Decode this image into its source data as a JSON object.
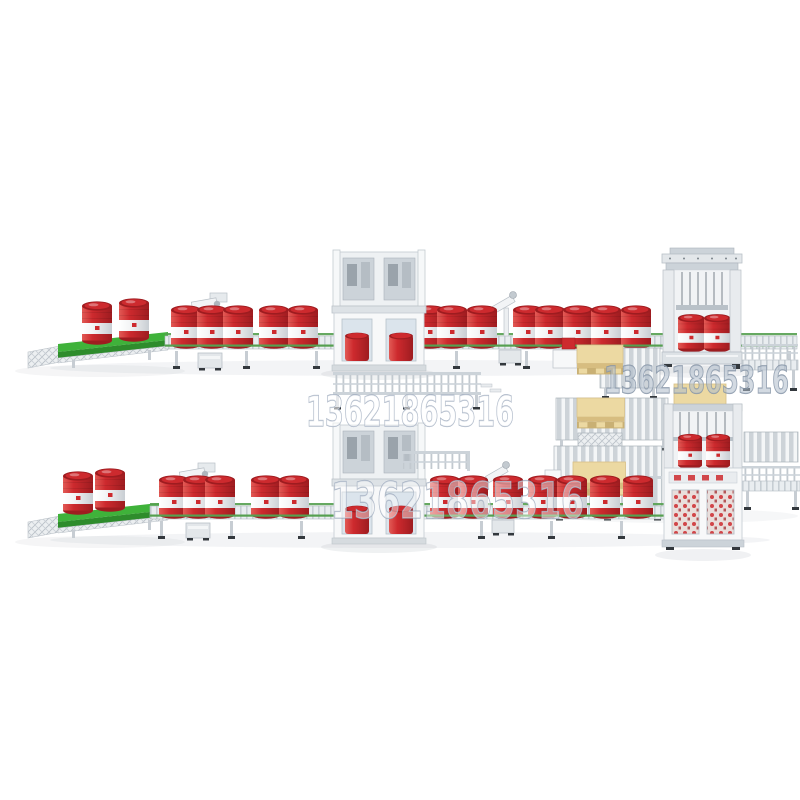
{
  "image": {
    "alt": "3D render of an automatic oil-drum filling and palletizing production line: two parallel conveyor lines with red drums, filling cabinets, capping robots, and a palletizing area with wooden pallets on the right"
  },
  "watermarks": [
    {
      "text": "13621865316",
      "position": "top-right"
    },
    {
      "text": "13621865316",
      "position": "center"
    },
    {
      "text": "13621865316",
      "position": "bottom-center"
    }
  ],
  "colors": {
    "background": "#ffffff",
    "drum_red": "#cd2a2e",
    "drum_red_dark": "#9e1c20",
    "drum_red_light": "#e25a55",
    "drum_band": "#f2f3f4",
    "belt_green": "#3fb23a",
    "belt_green_dark": "#2e8c2c",
    "rail_green": "#55a050",
    "machine_white": "#f7f8f9",
    "panel_light": "#e9ecef",
    "panel_mid": "#ccd3d9",
    "panel_dark": "#9aa2aa",
    "pallet_beige": "#ecd9a2",
    "pallet_beige_dark": "#d7bd80",
    "glass_blue": "#dbe4ec",
    "foot_dark": "#33383d",
    "watermark_fill": "#ffffff",
    "watermark_stroke": "#97a5b8"
  }
}
